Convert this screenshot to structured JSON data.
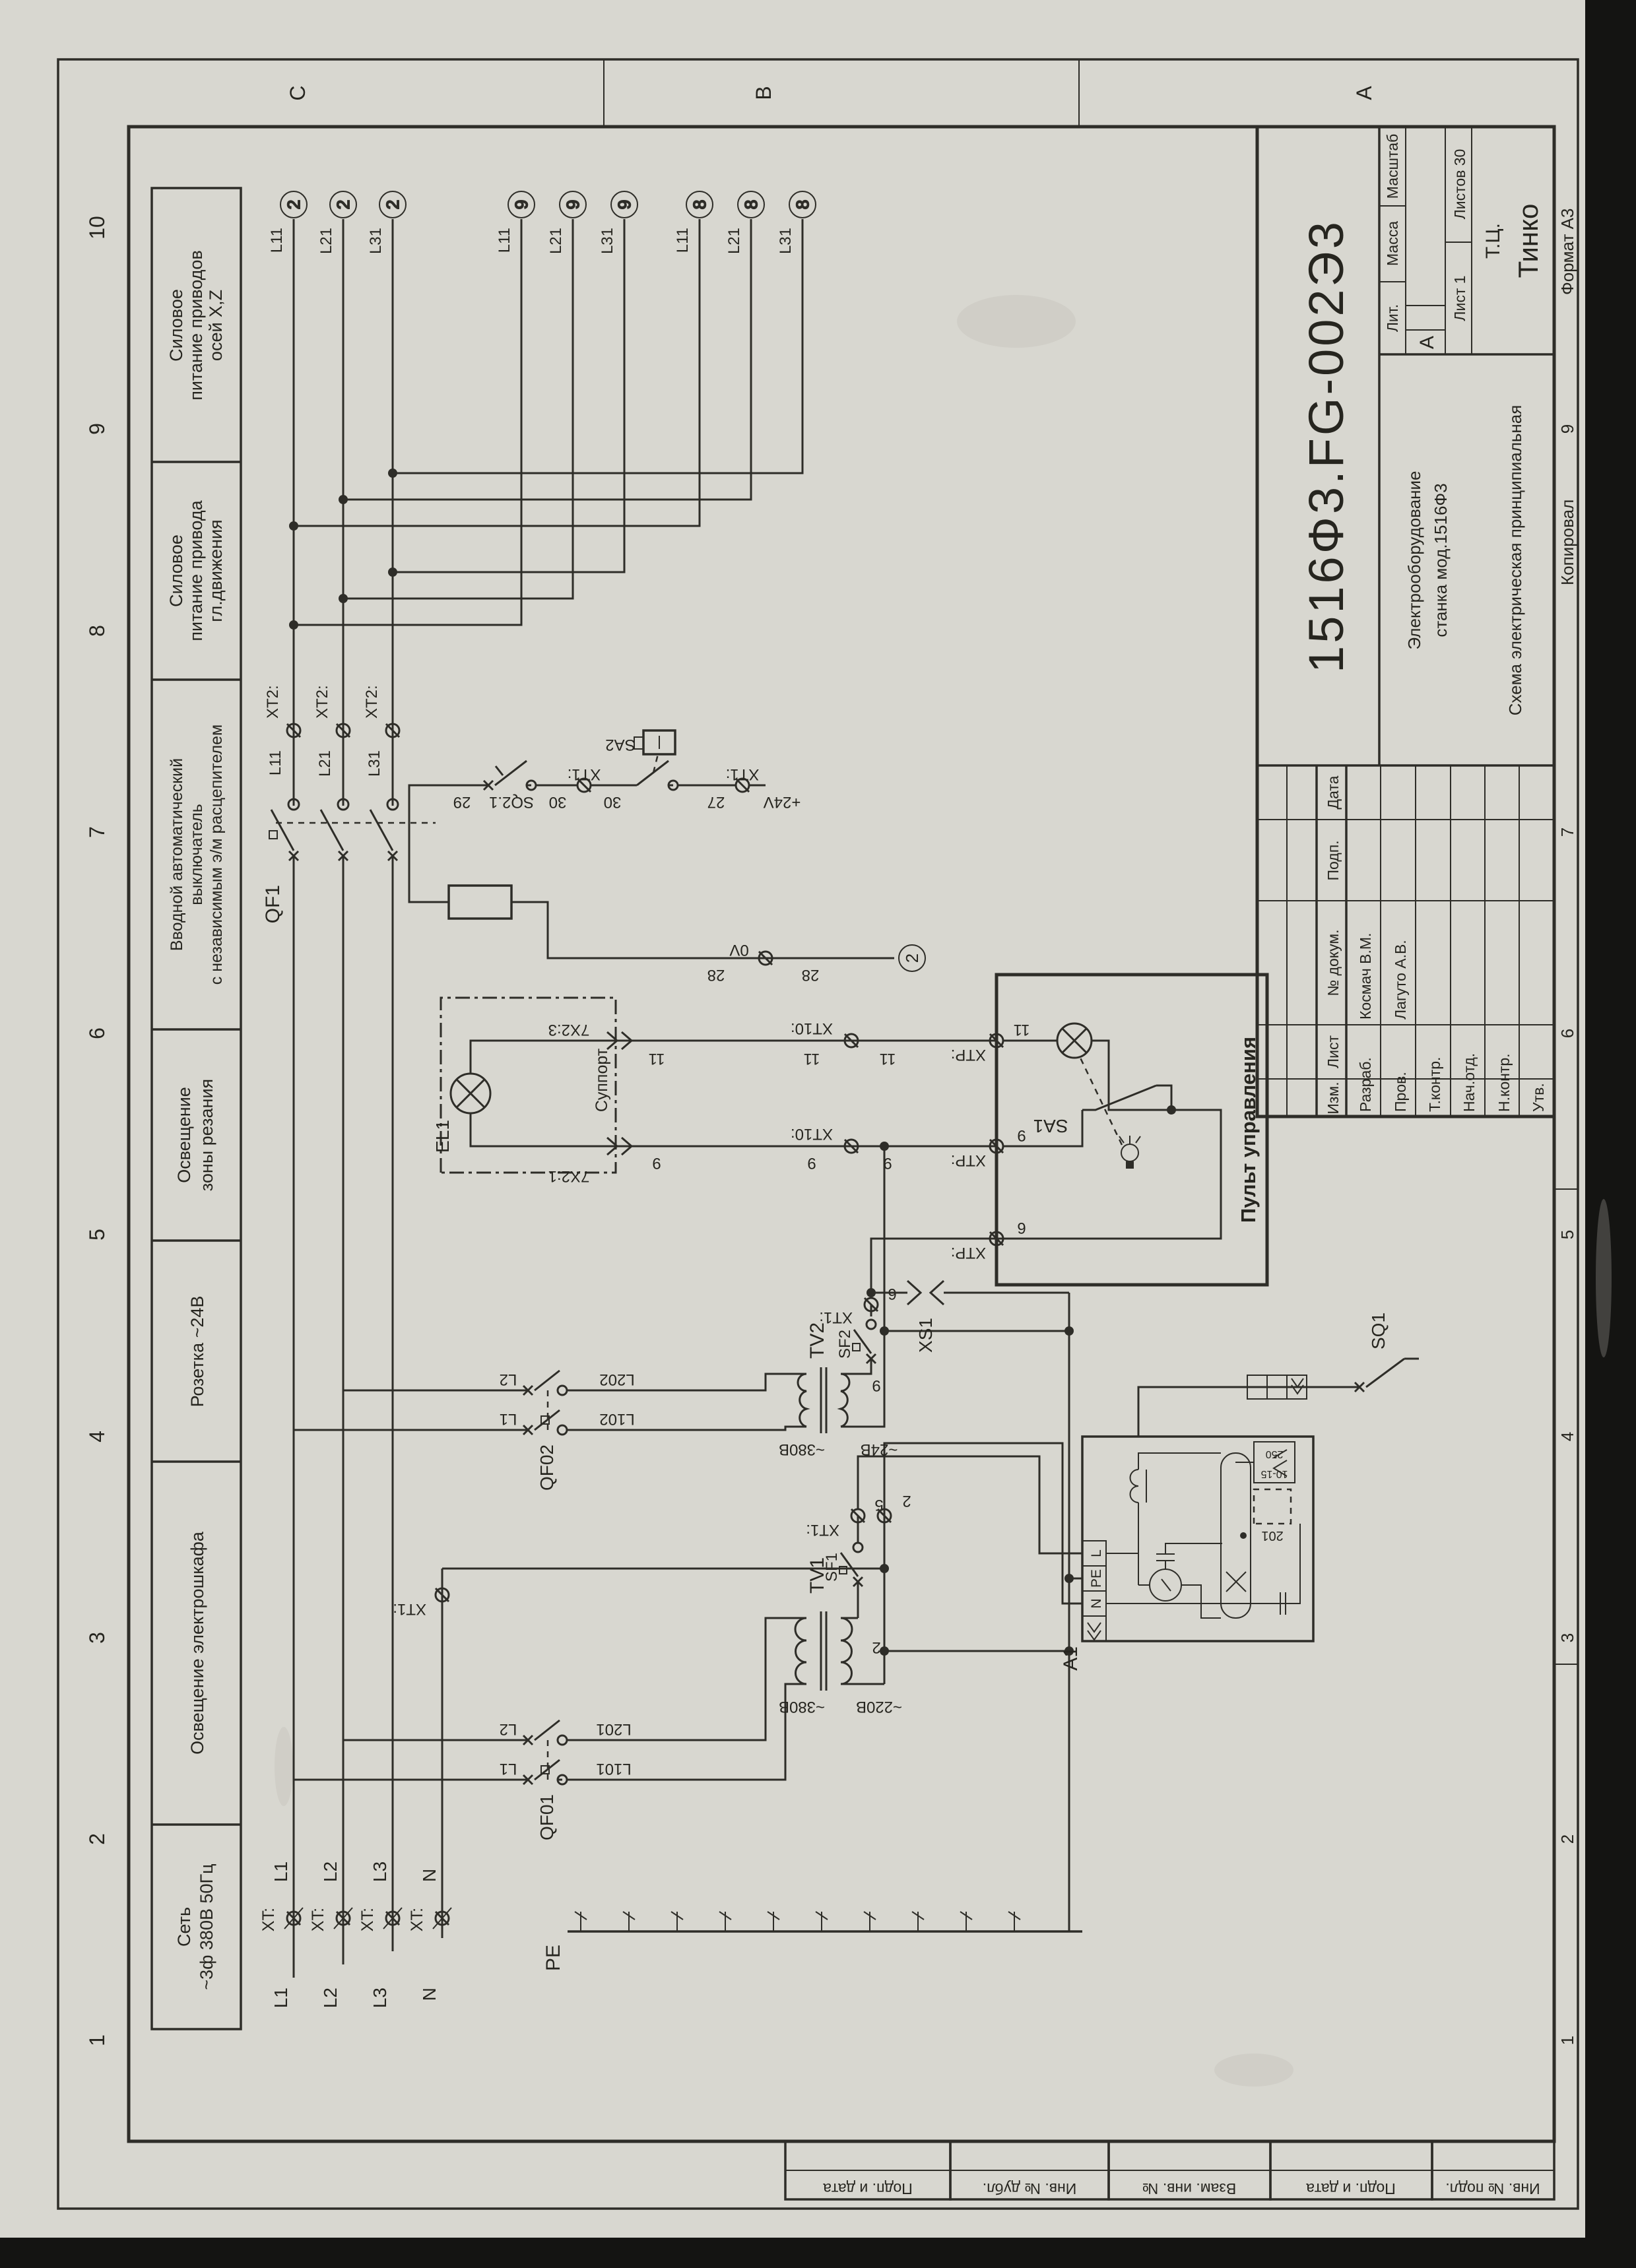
{
  "doc": {
    "number": "1516Ф3.FG-002Э3",
    "name_line1": "Электрооборудование",
    "name_line2": "станка мод.1516Ф3",
    "name_line3": "Схема электрическая принципиальная",
    "lit_header": "Лит.",
    "lit_value": "А",
    "mass_header": "Масса",
    "scale_header": "Масштаб",
    "sheet_label": "Лист 1",
    "sheets_label": "Листов 30",
    "org_line1": "Т.Ц.",
    "org_line2": "Тинко",
    "copied": "Копировал",
    "format": "Формат А3",
    "cols": {
      "izm": "Изм.",
      "list": "Лист",
      "docnum": "№ докум.",
      "podp": "Подп.",
      "data": "Дата"
    },
    "rows": {
      "razrab": "Разраб.",
      "prov": "Пров.",
      "tkontr": "Т.контр.",
      "nachotd": "Нач.отд.",
      "nkontr": "Н.контр.",
      "utv": "Утв."
    },
    "names": {
      "razrab": "Космач В.М.",
      "prov": "Лагуто А.В."
    }
  },
  "margin": {
    "cols": [
      "Подп. и дата",
      "Инв. № дубл.",
      "Взам. инв. №",
      "Подп. и дата",
      "Инв. № подл."
    ]
  },
  "zones": {
    "numbers": [
      "1",
      "2",
      "3",
      "4",
      "5",
      "6",
      "7",
      "8",
      "9",
      "10"
    ],
    "letters": [
      "C",
      "B",
      "A"
    ]
  },
  "sections": {
    "s1": [
      "Сеть",
      "~3ф 380В 50Гц"
    ],
    "s2": [
      "Освещение электрошкафа"
    ],
    "s3": [
      "Розетка ~24В"
    ],
    "s4": [
      "Освещение",
      "зоны резания"
    ],
    "s5": [
      "Вводной автоматический",
      "выключатель",
      "с независимым э/м расцепителем"
    ],
    "s6": [
      "Силовое",
      "питание привода",
      "гл.движения"
    ],
    "s7": [
      "Силовое",
      "питание приводов",
      "осей X,Z"
    ]
  },
  "mains": {
    "xt": "XT:",
    "l1": "L1",
    "l2": "L2",
    "l3": "L3",
    "n": "N",
    "pe": "PE"
  },
  "qf1": {
    "ref": "QF1",
    "xt2": "XT2:",
    "l11": "L11",
    "l21": "L21",
    "l31": "L31",
    "r2": "2",
    "r9": "9",
    "r8": "8"
  },
  "ctl": {
    "w29": "29",
    "sq21": "SQ2.1",
    "w30": "30",
    "xt1": "XT1:",
    "sa2": "SA2",
    "w27": "27",
    "p24": "+24V",
    "w28": "28",
    "zv": "0V",
    "r2": "2"
  },
  "cab": {
    "qf01": "QF01",
    "l1": "L1",
    "l101": "L101",
    "l2": "L2",
    "l201": "L201",
    "tv1": "TV1",
    "v380": "~380В",
    "v220": "~220В",
    "sf1": "SF1",
    "w5": "5",
    "w2": "2",
    "xt1": "XT1:",
    "a1": "A1",
    "tl": "L",
    "tpe": "PE",
    "tn": "N",
    "e201": "201",
    "r1015": "10-15",
    "r250": "250",
    "sq1": "SQ1"
  },
  "soc": {
    "qf02": "QF02",
    "l1": "L1",
    "l102": "L102",
    "l2": "L2",
    "l202": "L202",
    "tv2": "TV2",
    "v380": "~380В",
    "v24": "~24В",
    "sf2": "SF2",
    "w6": "6",
    "w9": "9",
    "xs1": "XS1",
    "xt1": "XT1:"
  },
  "cut": {
    "el1": "EL1",
    "c3": "7X2:3",
    "c1": "7X2:1",
    "sup": "Суппорт",
    "w11": "11",
    "w9": "9",
    "xt10": "XT10:"
  },
  "panel": {
    "title": "Пульт управления",
    "xtp": "XTP:",
    "sa1": "SA1",
    "w11": "11",
    "w9": "9",
    "w6": "6"
  }
}
